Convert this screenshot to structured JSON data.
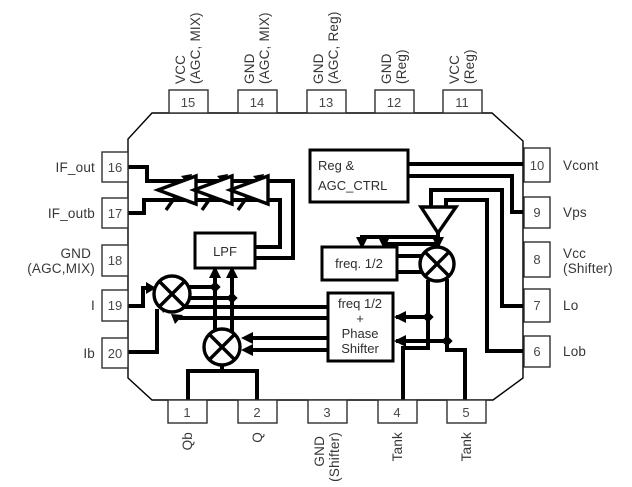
{
  "title": "IC block diagram",
  "pins": {
    "top": [
      {
        "num": "15",
        "l1": "VCC",
        "l2": "(AGC, MIX)"
      },
      {
        "num": "14",
        "l1": "GND",
        "l2": "(AGC, MIX)"
      },
      {
        "num": "13",
        "l1": "GND",
        "l2": "(AGC, Reg)"
      },
      {
        "num": "12",
        "l1": "GND",
        "l2": "(Reg)"
      },
      {
        "num": "11",
        "l1": "VCC",
        "l2": "(Reg)"
      }
    ],
    "left": [
      {
        "num": "16",
        "label": "IF_out"
      },
      {
        "num": "17",
        "label": "IF_outb"
      },
      {
        "num": "18",
        "l1": "GND",
        "l2": "(AGC,MIX)"
      },
      {
        "num": "19",
        "label": "I"
      },
      {
        "num": "20",
        "label": "Ib"
      }
    ],
    "right": [
      {
        "num": "10",
        "label": "Vcont"
      },
      {
        "num": "9",
        "label": "Vps"
      },
      {
        "num": "8",
        "l1": "Vcc",
        "l2": "(Shifter)"
      },
      {
        "num": "7",
        "label": "Lo"
      },
      {
        "num": "6",
        "label": "Lob"
      }
    ],
    "bottom": [
      {
        "num": "1",
        "label": "Qb"
      },
      {
        "num": "2",
        "label": "Q"
      },
      {
        "num": "3",
        "l1": "GND",
        "l2": "(Shifter)"
      },
      {
        "num": "4",
        "label": "Tank"
      },
      {
        "num": "5",
        "label": "Tank"
      }
    ]
  },
  "blocks": {
    "reg": {
      "line1": "Reg &",
      "line2": "AGC_CTRL"
    },
    "lpf": {
      "label": "LPF"
    },
    "freq_half": {
      "label": "freq. 1/2"
    },
    "shifter": {
      "line1": "freq 1/2",
      "line2": "+",
      "line3": "Phase",
      "line4": "Shifter"
    }
  },
  "colors": {
    "line": "#000000",
    "text": "#3a3a3a",
    "background": "#ffffff"
  }
}
